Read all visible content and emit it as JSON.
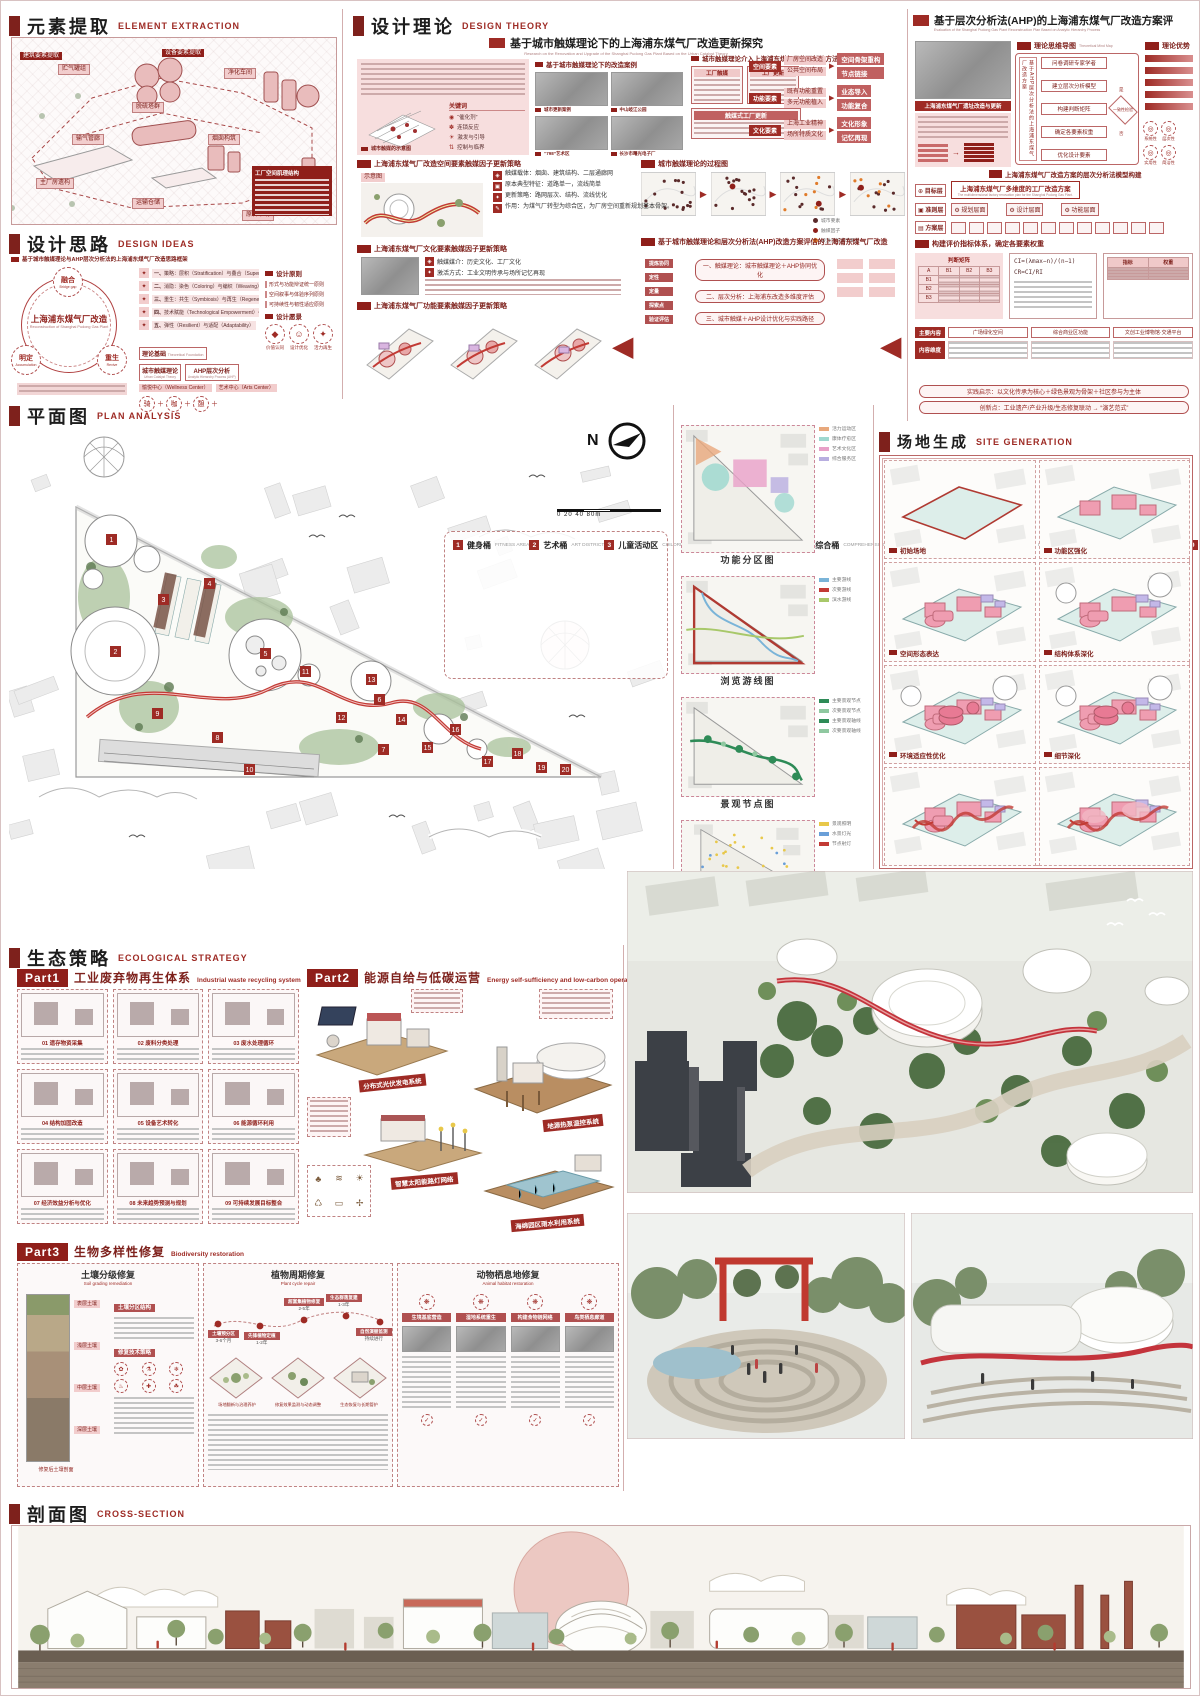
{
  "headers": {
    "element_extraction": {
      "zh": "元素提取",
      "en": "ELEMENT EXTRACTION"
    },
    "design_ideas": {
      "zh": "设计思路",
      "en": "DESIGN IDEAS"
    },
    "design_theory": {
      "zh": "设计理论",
      "en": "DESIGN THEORY"
    },
    "plan": {
      "zh": "平面图",
      "en": "PLAN ANALYSIS"
    },
    "site_generation": {
      "zh": "场地生成",
      "en": "SITE GENERATION"
    },
    "ecology": {
      "zh": "生态策略",
      "en": "ECOLOGICAL STRATEGY"
    },
    "cross_section": {
      "zh": "剖面图",
      "en": "CROSS-SECTION"
    }
  },
  "element_extraction": {
    "banners": [
      "建筑要素提取",
      "设备要素提取"
    ],
    "chips": [
      "贮气罐组",
      "脱硫塔群",
      "净化车间",
      "输气管廊",
      "主厂房遗构",
      "烟囱构筑",
      "运输仓储",
      "原料堆场"
    ],
    "block_title": "工厂空间肌理结构"
  },
  "design_ideas": {
    "subtitle": "基于城市触媒理论与AHP层次分析法的上海浦东煤气厂改造思路框架",
    "circle": {
      "center_zh": "上海浦东煤气厂改造",
      "center_en": "Reconstruction of Shanghai Pudong Gas Plant",
      "nodes": [
        {
          "zh": "融合",
          "en": "Bridge gap"
        },
        {
          "zh": "明定",
          "en": "Accumulation"
        },
        {
          "zh": "重生",
          "en": "Revive"
        }
      ]
    },
    "strategies": [
      {
        "n": "一、",
        "t": "策略：层积（Stratification）与叠合（Superimposition）"
      },
      {
        "n": "二、",
        "t": "消隐：染色（Coloring）与编织（Weaving）"
      },
      {
        "n": "三、",
        "t": "重生：共生（Symbiosis）与再生（Regeneration）"
      },
      {
        "n": "四、",
        "t": "技术赋能（Technological Empowerment）与交互（Interaction）"
      },
      {
        "n": "五、",
        "t": "弹性（Resilient）与适配（Adaptability）"
      }
    ],
    "principles": {
      "title": "设计原则",
      "items": [
        "形式与功能辩证统一原则",
        "空间叙事与体验序列原则",
        "可持续性与韧性适应原则"
      ],
      "vision": "设计愿景"
    },
    "vision_icons": [
      {
        "g": "◆",
        "t": "价值认同"
      },
      {
        "g": "☺",
        "t": "设计优化"
      },
      {
        "g": "✦",
        "t": "活力再生"
      }
    ],
    "foundation": {
      "label_zh": "理论基础",
      "label_en": "Theoretical Foundation",
      "nodes": [
        {
          "zh": "城市触媒理论",
          "en": "Urban Catalyst Theory"
        },
        {
          "zh": "AHP层次分析",
          "en": "Analytic Hierarchy Process (AHP)"
        }
      ],
      "centers": [
        "愉悦中心（Wellness Center）",
        "艺术中心（Arts Center）"
      ],
      "icons": [
        "骑",
        "咖",
        "憩"
      ]
    }
  },
  "design_theory": {
    "study_title": "基于城市触媒理论下的上海浦东煤气厂改造更新探究",
    "study_en": "Research on the Renovation and Upgrade of the Shanghai Pudong Gas Plant Based on the Urban Catalyst Theory",
    "keywords_title": "关键词",
    "keywords": [
      {
        "g": "◉",
        "t": "“催化剂”"
      },
      {
        "g": "✽",
        "t": "连锁反应"
      },
      {
        "g": "☀",
        "t": "激发与引导"
      },
      {
        "g": "⇅",
        "t": "控制与临界"
      }
    ],
    "catalyst_caption": "城市触媒的示意图",
    "cases_title": "基于城市触媒理论下的改造案例",
    "case_captions": [
      "城市更新案例",
      "中山岐江公园",
      "“798”艺术区",
      "长沙市曙光电子厂"
    ],
    "space_strategy_title": "上海浦东煤气厂改造空间要素触媒因子更新策略",
    "schematic_label": "示意图",
    "space_bullets": [
      {
        "g": "◈",
        "t": "触媒载体：烟囱、建筑结构、二层通廊网"
      },
      {
        "g": "▣",
        "t": "原本典型特征：道路单一，流线简单"
      },
      {
        "g": "✦",
        "t": "更新策略：路网层次、结构、流线优化"
      },
      {
        "g": "✎",
        "t": "作用：为煤气厂转型为综合区，为厂房空间重新规划基本骨架。"
      }
    ],
    "culture_strategy_title": "上海浦东煤气厂文化要素触媒因子更新策略",
    "culture_bullets": [
      {
        "g": "◈",
        "t": "触媒媒介：历史文化、工厂文化"
      },
      {
        "g": "✦",
        "t": "激活方式：工业文明传承与场所记忆再现"
      }
    ],
    "function_strategy_title": "上海浦东煤气厂功能要素触媒因子更新策略",
    "method_title": "城市触媒理论介入上海浦东煤气厂的更新的方法构建",
    "method_left": [
      {
        "t": "工厂触媒"
      },
      {
        "t": "工厂更新"
      }
    ],
    "method_merge": "触媒式工厂更新",
    "method_elements": [
      {
        "t": "空间要素",
        "c1": "厂房空间改造",
        "c2": "公共空间布局",
        "o1": "空间骨架重构",
        "o2": "节点链接"
      },
      {
        "t": "功能要素",
        "c1": "既有功能重置",
        "c2": "多元功能植入",
        "o1": "业态导入",
        "o2": "功能复合"
      },
      {
        "t": "文化要素",
        "c1": "上海工业精神",
        "c2": "场所特质文化",
        "o1": "文化形象",
        "o2": "记忆再现"
      }
    ],
    "process_title": "城市触媒理论的过程图",
    "process_legend": [
      {
        "c": "#5a2a2a",
        "t": "城市要素"
      },
      {
        "c": "#8f1f1a",
        "t": "触媒因子"
      },
      {
        "c": "#e07b2a",
        "t": "被激活的城市要素"
      }
    ],
    "synergy_title": "基于城市触媒理论和层次分析法(AHP)改造方案评估的上海浦东煤气厂改造",
    "synergy_rows": [
      "一、触媒理论：城市触媒理论＋AHP协同优化",
      "二、层次分析：上海浦东改造多维度评估",
      "三、城市触媒＋AHP设计优化与实践路径"
    ],
    "synergy_side": [
      "提炼协同",
      "定性",
      "定量",
      "探索点",
      "验证评估"
    ]
  },
  "ahp": {
    "title": "基于层次分析法(AHP)的上海浦东煤气厂改造方案评",
    "title_en": "Evaluation of the Shanghai Pudong Gas Plant Reconstruction Plan Based on Analytic Hierarchy Process",
    "intro_title": "上海浦东煤气厂遗址改造与更新",
    "mindmap_title": "理论思维导图",
    "mindmap_title_en": "Theoretical Mind Map",
    "mindmap_side": "基于AHP层次分析法的上海浦东煤气厂改造方案",
    "mindmap_steps": [
      "问卷调研专家学者",
      "建立层次分析模型",
      "构建判断矩阵",
      "确定各要素权重",
      "优化设计要素"
    ],
    "mindmap_check": "一致性检验",
    "yes": "是",
    "no": "否",
    "advantages_title": "理论优势",
    "advantage_icons": [
      {
        "t": "系统性"
      },
      {
        "t": "层次性"
      },
      {
        "t": "实用性"
      },
      {
        "t": "简洁性"
      }
    ],
    "model_title": "上海浦东煤气厂改造方案的层次分析法模型构建",
    "layers": {
      "goal_label": "目标层",
      "goal": "上海浦东煤气厂多维度的工厂改造方案",
      "goal_en": "The multidimensional factory renovation plan for the Shanghai Pudong Gas Plant.",
      "criteria_label": "准则层",
      "criteria": [
        "规划层面",
        "设计层面",
        "功能层面"
      ],
      "scheme_label": "方案层"
    },
    "weights_title": "构建评价指标体系，确定各要素权重",
    "matrix_title": "判断矩阵",
    "formulas": [
      "CI=(λmax−n)/(n−1)",
      "CR=CI/RI"
    ],
    "weight_headers": [
      "指标",
      "权重"
    ],
    "table_heads": [
      "主要内容",
      "内容维度"
    ],
    "table_cells": [
      "广场绿化空间",
      "综合商业区功能",
      "文创工业博物馆·交通平台"
    ],
    "insight": "实践启示：以文化传承为核心＋绿色景观为骨架＋社区参与为主体",
    "innovation": "创新点：工业遗产/产业升级/生态修复联动 → “演艺范式”"
  },
  "plan": {
    "north": "N",
    "scale": "0   20   40        80m",
    "legend": [
      {
        "n": "1",
        "zh": "健身桶",
        "en": "FITNESS AREA"
      },
      {
        "n": "2",
        "zh": "艺术桶",
        "en": "ART DISTRICT"
      },
      {
        "n": "3",
        "zh": "儿童活动区",
        "en": "CHILDREN'S ACTIVITY AREA"
      },
      {
        "n": "4",
        "zh": "办公区",
        "en": "OFFICE AREA"
      },
      {
        "n": "5",
        "zh": "综合桶",
        "en": "COMPREHENSIVE AREA"
      },
      {
        "n": "6",
        "zh": "娱乐桶",
        "en": "ENTERTAINMENT AREA"
      },
      {
        "n": "7",
        "zh": "疗愈桶",
        "en": "HEALING AREA"
      },
      {
        "n": "8",
        "zh": "工厂遗迹",
        "en": "REMAINS OF THE FACTORY"
      },
      {
        "n": "9",
        "zh": "室外氧吧",
        "en": "OUTDOOR OXYGEN BAR"
      },
      {
        "n": "10",
        "zh": "运作工厂",
        "en": "OPERATING FACTORIES"
      },
      {
        "n": "11",
        "zh": "花海漫步道",
        "en": "FLOWER SEA STROLL"
      },
      {
        "n": "12",
        "zh": "观景台",
        "en": "OBSERVATION DECK"
      },
      {
        "n": "13",
        "zh": "艺术长廊",
        "en": "ART GALLERY"
      },
      {
        "n": "14",
        "zh": "健身广场",
        "en": "FITNESS PLAZA"
      },
      {
        "n": "15",
        "zh": "秋千乐憩区",
        "en": "SWING RELAXATION"
      },
      {
        "n": "16",
        "zh": "下沉式休憩区",
        "en": "SUNKEN REST AREA"
      },
      {
        "n": "17",
        "zh": "沙趣乐园",
        "en": "SAND FUN PARADISE"
      },
      {
        "n": "18",
        "zh": "水景区",
        "en": "WATER SCENIC SPOT"
      },
      {
        "n": "19",
        "zh": "水景步道",
        "en": "WATER TRAIL"
      },
      {
        "n": "20",
        "zh": "亲水区",
        "en": "WATER-FRIENDLY AREA"
      }
    ],
    "minimaps": [
      {
        "caption": "功能分区图",
        "legend": [
          {
            "c": "#e8a87c",
            "t": "活力运动区"
          },
          {
            "c": "#9fd8cf",
            "t": "康体疗愈区"
          },
          {
            "c": "#e8a0c8",
            "t": "艺术文化区"
          },
          {
            "c": "#b8aee0",
            "t": "综合服务区"
          }
        ]
      },
      {
        "caption": "浏览游线图",
        "legend": [
          {
            "c": "#7ab4d8",
            "t": "主要游线"
          },
          {
            "c": "#c23b35",
            "t": "次要游线"
          },
          {
            "c": "#a8c86a",
            "t": "滨水游线"
          }
        ]
      },
      {
        "caption": "景观节点图",
        "legend": [
          {
            "c": "#2e8b57",
            "t": "主要景观节点"
          },
          {
            "c": "#8fc8a0",
            "t": "次要景观节点"
          },
          {
            "c": "#2e8b57",
            "t": "主要景观轴线"
          },
          {
            "c": "#8fc8a0",
            "t": "次要景观轴线"
          }
        ]
      },
      {
        "caption": "灯光布置图",
        "legend": [
          {
            "c": "#e8c84a",
            "t": "景观照明"
          },
          {
            "c": "#6a9fd8",
            "t": "水景灯光"
          },
          {
            "c": "#c23b35",
            "t": "节点射灯"
          }
        ]
      }
    ]
  },
  "site_generation": {
    "steps": [
      "初始场地",
      "功能区强化",
      "空间形态表达",
      "结构体系深化",
      "环境适应性优化",
      "细节深化"
    ]
  },
  "ecology": {
    "part1": {
      "tag": "Part1",
      "zh": "工业废弃物再生体系",
      "en": "Industrial waste recycling system",
      "items": [
        {
          "n": "01",
          "t": "遗存物资采集"
        },
        {
          "n": "02",
          "t": "废料分类处理"
        },
        {
          "n": "03",
          "t": "废水处理循环"
        },
        {
          "n": "04",
          "t": "结构加固改造"
        },
        {
          "n": "05",
          "t": "设备艺术转化"
        },
        {
          "n": "06",
          "t": "能源循环利用"
        },
        {
          "n": "07",
          "t": "经济效益分析与优化"
        },
        {
          "n": "08",
          "t": "未来趋势预测与规划"
        },
        {
          "n": "09",
          "t": "可持续发展目标整合"
        }
      ]
    },
    "part2": {
      "tag": "Part2",
      "zh": "能源自给与低碳运营",
      "en": "Energy self-sufficiency and low-carbon operations",
      "systems": [
        "分布式光伏发电系统",
        "地源热泵温控系统",
        "智慧太阳能路灯网络",
        "海绵园区雨水利用系统"
      ]
    },
    "part3": {
      "tag": "Part3",
      "zh": "生物多样性修复",
      "en": "Biodiversity restoration",
      "p1": {
        "zh": "土壤分级修复",
        "en": "Soil grading remediation",
        "chips": [
          "土壤分区结构",
          "修复技术策略"
        ],
        "layers": [
          "表层土壤",
          "浅层土壤",
          "中层土壤",
          "深层土壤"
        ],
        "caption": "修复后土壤剖面"
      },
      "p2": {
        "zh": "植物周期修复",
        "en": "Plant cycle repair",
        "stages": [
          {
            "t": "土壤预分区",
            "d": "3-6个月"
          },
          {
            "t": "先锋植物定植",
            "d": "1-2年"
          },
          {
            "t": "超富集植物修复",
            "d": "2-5年"
          },
          {
            "t": "生态群落复建",
            "d": "1-3年"
          },
          {
            "t": "自然演替监测",
            "d": "持续进行"
          }
        ],
        "captions": [
          "场地翻新与治理养护",
          "修复效果监测与动态调整",
          "生态恢复与长期管护"
        ]
      },
      "p3": {
        "zh": "动物栖息地修复",
        "en": "Animal habitat restoration",
        "chips": [
          "生境基底营造",
          "湿地系统重生",
          "构建食物链网络",
          "鸟类栖息廊道"
        ]
      }
    }
  }
}
